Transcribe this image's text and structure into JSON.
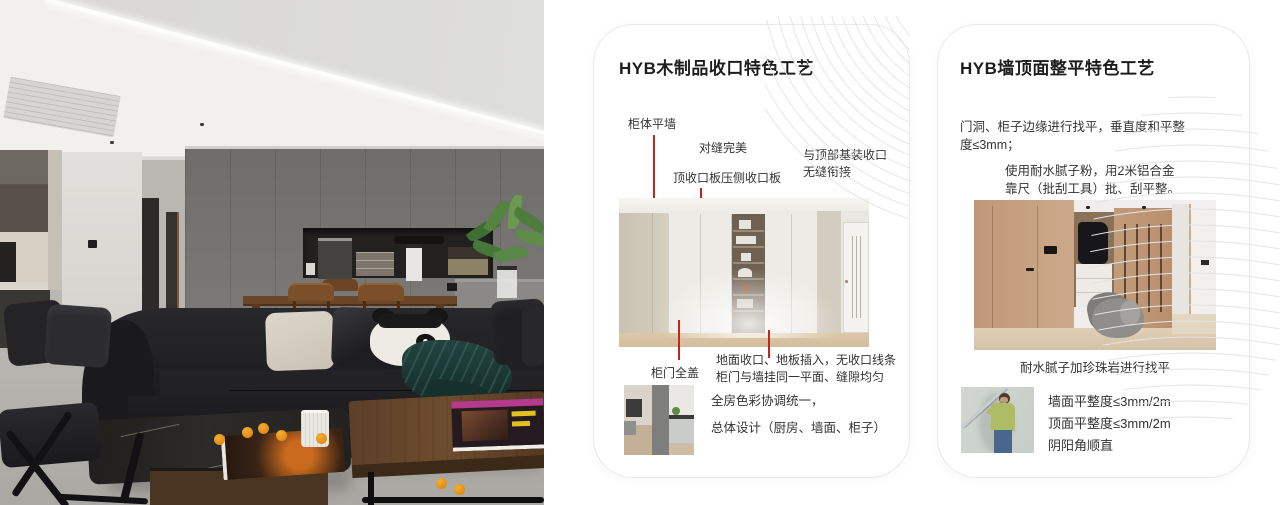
{
  "colors": {
    "annotation_red": "#c2271d",
    "card_border": "#e9e9e9",
    "pattern_line": "#e6e6e6"
  },
  "card1": {
    "title": "HYB木制品收口特色工艺",
    "label_cabinet_flush_wall": "柜体平墙",
    "label_perfect_seam": "对缝完美",
    "label_top_trim": "顶收口板压侧收口板",
    "label_ceiling_joint_1": "与顶部基装收口",
    "label_ceiling_joint_2": "无缝衔接",
    "label_full_cover_door": "柜门全盖",
    "label_floor_joint_1": "地面收口、地板插入，无收口线条",
    "label_floor_joint_2": "柜门与墙挂同一平面、缝隙均匀",
    "summary_1": "全房色彩协调统一，",
    "summary_2": "总体设计（厨房、墙面、柜子）"
  },
  "card2": {
    "title": "HYB墙顶面整平特色工艺",
    "para1_1": "门洞、柜子边缘进行找平，垂直度和平整",
    "para1_2": "度≤3mm；",
    "para2_1": "使用耐水腻子粉，用2米铝合金",
    "para2_2": "靠尺（批刮工具）批、刮平整。",
    "caption": "耐水腻子加珍珠岩进行找平",
    "bullets": [
      "墙面平整度≤3mm/2m",
      "顶面平整度≤3mm/2m",
      "阴阳角顺直"
    ]
  }
}
